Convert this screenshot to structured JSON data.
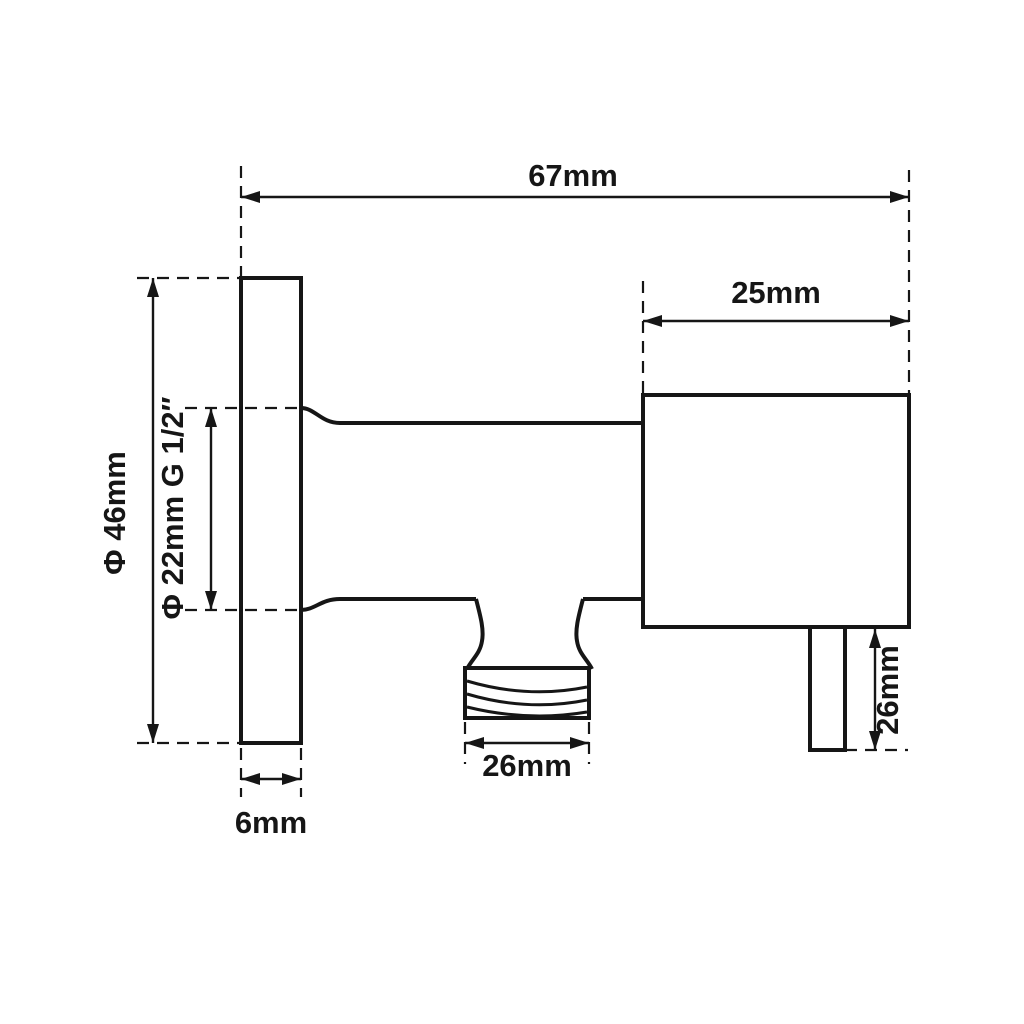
{
  "drawing": {
    "background_color": "#ffffff",
    "line_color": "#161616",
    "labels": {
      "overall_width": "67mm",
      "body_width": "25mm",
      "flange_diameter": "Φ 46mm",
      "inlet_spec": "Φ 22mm G 1/2″",
      "flange_thickness": "6mm",
      "outlet_width": "26mm",
      "stub_height": "26mm"
    }
  }
}
